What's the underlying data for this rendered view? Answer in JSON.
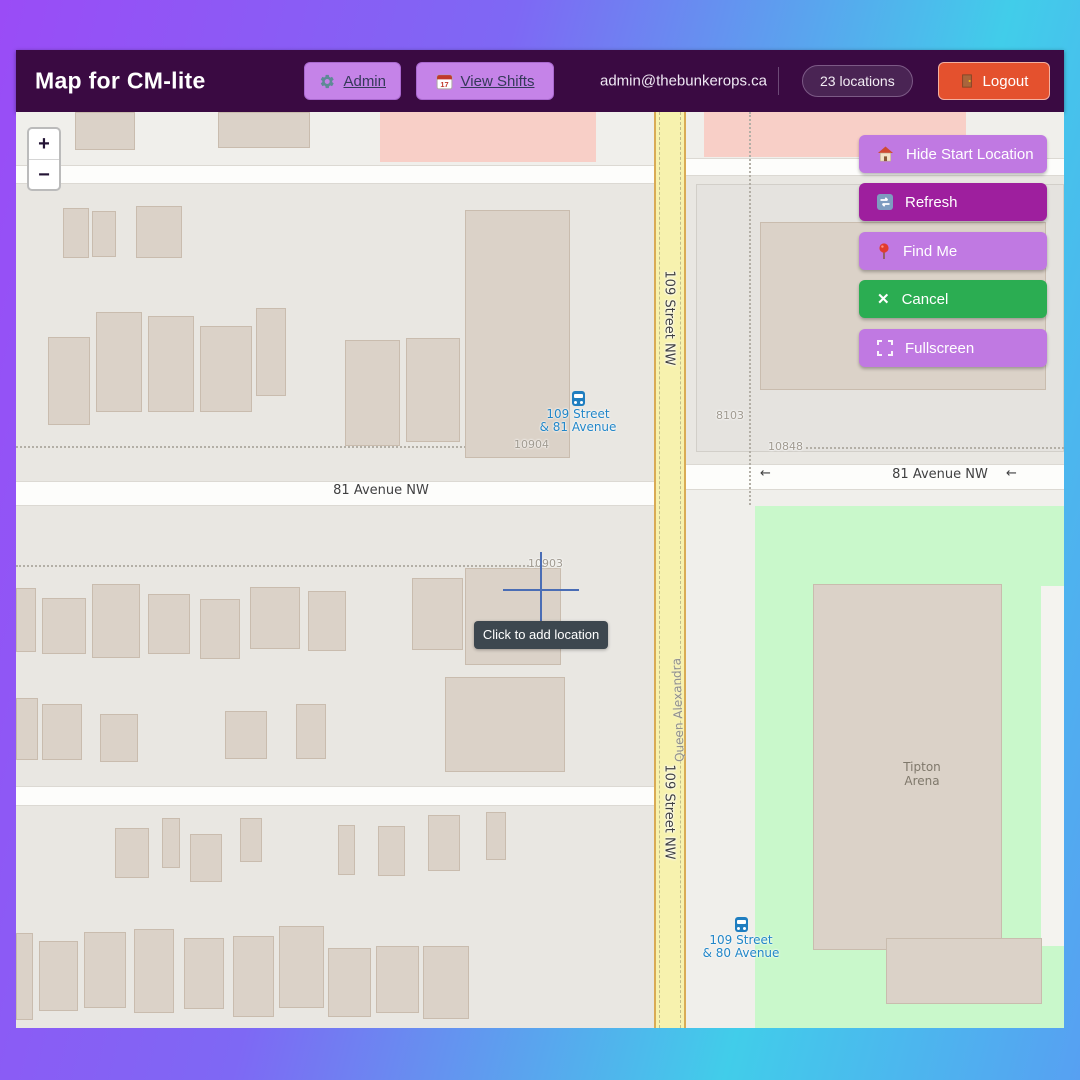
{
  "header": {
    "title": "Map for CM-lite",
    "admin_label": "Admin",
    "view_shifts_label": "View Shifts",
    "email": "admin@thebunkerops.ca",
    "locations_badge": "23 locations",
    "logout_label": "Logout"
  },
  "map_controls": {
    "zoom_in": "+",
    "zoom_out": "−",
    "buttons": [
      {
        "label": "Hide Start Location",
        "icon": "house-icon"
      },
      {
        "label": "Refresh",
        "icon": "refresh-icon"
      },
      {
        "label": "Find Me",
        "icon": "pin-icon"
      },
      {
        "label": "Cancel",
        "icon": "close-icon"
      },
      {
        "label": "Fullscreen",
        "icon": "fullscreen-icon"
      }
    ],
    "tooltip": "Click to add location"
  },
  "map": {
    "labels": {
      "avenue": "81 Avenue NW",
      "street": "109 Street NW",
      "neighborhood": "Queen Alexandra",
      "arena_line1": "Tipton",
      "arena_line2": "Arena",
      "one_way_arrow": "←"
    },
    "house_numbers": {
      "hn1": "10904",
      "hn2": "10848",
      "hn3": "10903",
      "hn4": "8103"
    },
    "bus_stops": [
      {
        "line1": "109 Street",
        "line2": "& 81 Avenue"
      },
      {
        "line1": "109 Street",
        "line2": "& 80 Avenue"
      }
    ]
  },
  "colors": {
    "header-bg": "#3a0a42",
    "btn-purple": "#c583e8",
    "map-btn-purple": "#c079e2",
    "btn-magenta": "#9e1f9e",
    "btn-green": "#2bad52",
    "logout-orange": "#e4512e",
    "badge-bg": "#4a2454",
    "road-yellow": "#f7f2ae",
    "road-edge": "#d9ab55",
    "park-green": "#c9f8cb",
    "pink-zone": "#f8cfc7",
    "building-fill": "#dbd2c8",
    "building-edge": "#c9bcae",
    "tooltip-bg": "#3d474f",
    "crosshair-blue": "#4a6db5",
    "bus-blue": "#2186c8",
    "grad-1": "#9a4cf6",
    "grad-2": "#7e68f4",
    "grad-3": "#41cdea",
    "grad-4": "#57a0f2"
  },
  "map_shapes": {
    "buildings": [
      [
        59,
        0,
        60,
        38
      ],
      [
        202,
        0,
        92,
        36
      ],
      [
        47,
        96,
        26,
        50
      ],
      [
        76,
        99,
        24,
        46
      ],
      [
        120,
        94,
        46,
        52
      ],
      [
        449,
        98,
        105,
        248
      ],
      [
        32,
        225,
        42,
        88
      ],
      [
        80,
        200,
        46,
        100
      ],
      [
        132,
        204,
        46,
        96
      ],
      [
        184,
        214,
        52,
        86
      ],
      [
        240,
        196,
        30,
        88
      ],
      [
        329,
        228,
        55,
        106
      ],
      [
        390,
        226,
        54,
        104
      ],
      [
        0,
        476,
        20,
        64
      ],
      [
        26,
        486,
        44,
        56
      ],
      [
        76,
        472,
        48,
        74
      ],
      [
        132,
        482,
        42,
        60
      ],
      [
        184,
        487,
        40,
        60
      ],
      [
        234,
        475,
        50,
        62
      ],
      [
        292,
        479,
        38,
        60
      ],
      [
        396,
        466,
        51,
        72
      ],
      [
        449,
        456,
        96,
        97
      ],
      [
        0,
        586,
        22,
        62
      ],
      [
        26,
        592,
        40,
        56
      ],
      [
        84,
        602,
        38,
        48
      ],
      [
        209,
        599,
        42,
        48
      ],
      [
        280,
        592,
        30,
        55
      ],
      [
        429,
        565,
        120,
        95
      ],
      [
        99,
        716,
        34,
        50
      ],
      [
        146,
        706,
        18,
        50
      ],
      [
        174,
        722,
        32,
        48
      ],
      [
        224,
        706,
        22,
        44
      ],
      [
        322,
        713,
        17,
        50
      ],
      [
        362,
        714,
        27,
        50
      ],
      [
        412,
        703,
        32,
        56
      ],
      [
        470,
        700,
        20,
        48
      ],
      [
        0,
        821,
        17,
        87
      ],
      [
        23,
        829,
        39,
        70
      ],
      [
        68,
        820,
        42,
        76
      ],
      [
        118,
        817,
        40,
        84
      ],
      [
        168,
        826,
        40,
        71
      ],
      [
        217,
        824,
        41,
        81
      ],
      [
        263,
        814,
        45,
        82
      ],
      [
        312,
        836,
        43,
        69
      ],
      [
        360,
        834,
        43,
        67
      ],
      [
        407,
        834,
        46,
        73
      ],
      [
        744,
        110,
        286,
        168
      ],
      [
        797,
        472,
        189,
        366
      ],
      [
        870,
        826,
        156,
        66
      ]
    ]
  }
}
